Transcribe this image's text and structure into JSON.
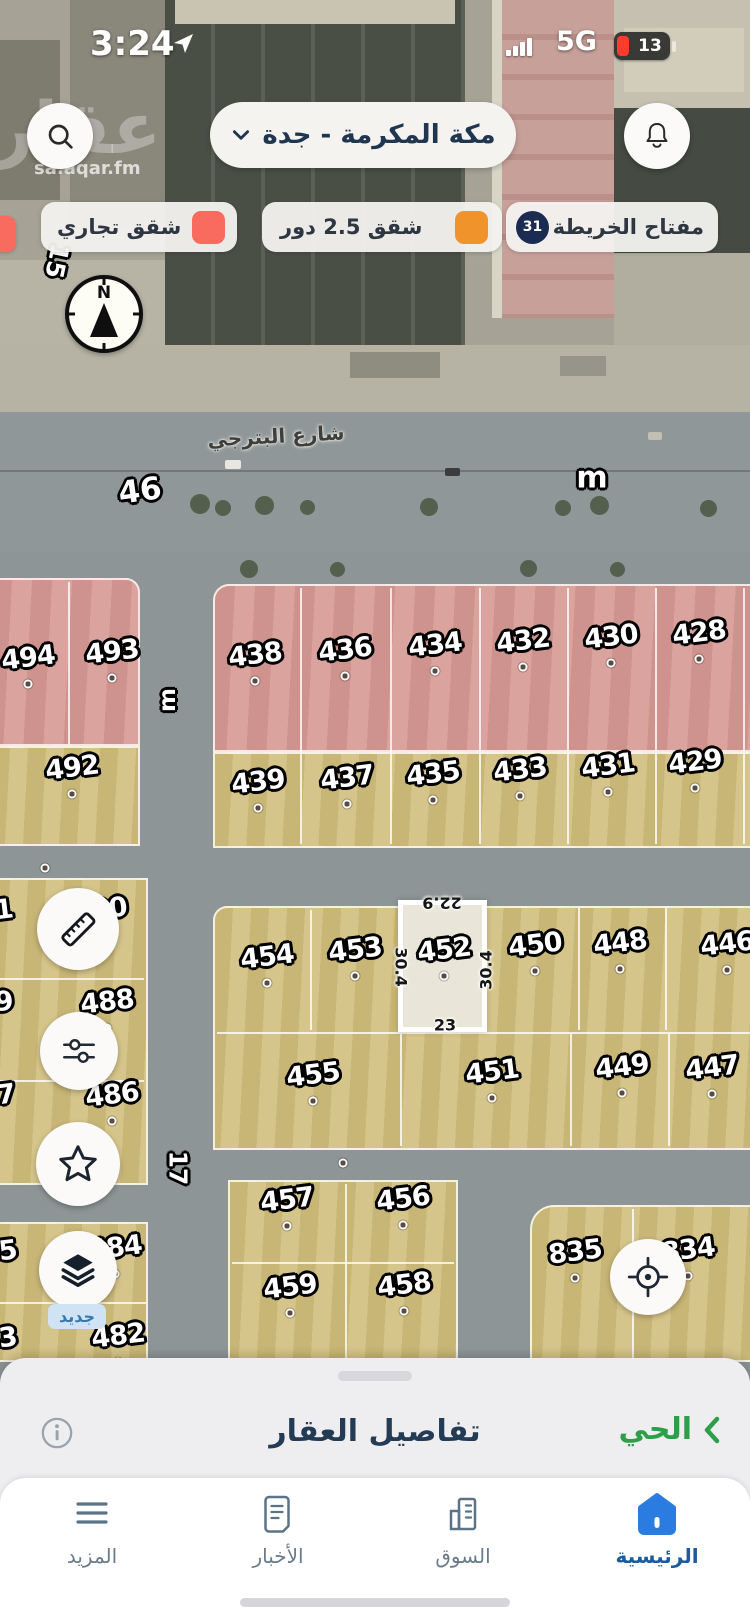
{
  "status_bar": {
    "time": "3:24",
    "network": "5G",
    "battery_percent": "13"
  },
  "watermark": {
    "logo": "عقار",
    "site": "sa.aqar.fm"
  },
  "header": {
    "location_selector": "مكة المكرمة - جدة"
  },
  "legend": {
    "map_key": {
      "label": "مفتاح الخريطة",
      "count": "31",
      "badge_color": "#1C2B52"
    },
    "chips": [
      {
        "label": "شقق 2.5 دور",
        "color": "#F1932B"
      },
      {
        "label": "شقق تجاري",
        "color": "#F96A5F"
      }
    ]
  },
  "map": {
    "street_name": "شارع البترجي",
    "compass_letter": "N",
    "new_badge": "جديد",
    "selected_parcel": "452",
    "dimensions": [
      {
        "t": "22.9",
        "x": 442,
        "y": 903,
        "rot": 180
      },
      {
        "t": "30.4",
        "x": 401,
        "y": 967,
        "rot": 90
      },
      {
        "t": "30.4",
        "x": 486,
        "y": 970,
        "rot": -90
      },
      {
        "t": "23",
        "x": 445,
        "y": 1025,
        "rot": 0
      }
    ],
    "road_labels": [
      {
        "t": "46",
        "x": 140,
        "y": 491,
        "rot": -8,
        "size": 31
      },
      {
        "t": "m",
        "x": 592,
        "y": 478,
        "rot": 0,
        "size": 30
      },
      {
        "t": "m",
        "x": 168,
        "y": 700,
        "rot": -90,
        "size": 23
      },
      {
        "t": "17",
        "x": 178,
        "y": 1168,
        "rot": 90,
        "size": 25
      },
      {
        "t": "15",
        "x": 57,
        "y": 261,
        "rot": 102,
        "size": 25
      }
    ],
    "parcels": [
      {
        "t": "494",
        "x": 28,
        "y": 658
      },
      {
        "t": "493",
        "x": 112,
        "y": 652
      },
      {
        "t": "438",
        "x": 255,
        "y": 655
      },
      {
        "t": "436",
        "x": 345,
        "y": 650
      },
      {
        "t": "434",
        "x": 435,
        "y": 645
      },
      {
        "t": "432",
        "x": 523,
        "y": 641
      },
      {
        "t": "430",
        "x": 611,
        "y": 637
      },
      {
        "t": "428",
        "x": 699,
        "y": 633
      },
      {
        "t": "492",
        "x": 72,
        "y": 768
      },
      {
        "t": "439",
        "x": 258,
        "y": 782
      },
      {
        "t": "437",
        "x": 347,
        "y": 778
      },
      {
        "t": "435",
        "x": 433,
        "y": 774
      },
      {
        "t": "433",
        "x": 520,
        "y": 770
      },
      {
        "t": "431",
        "x": 608,
        "y": 766
      },
      {
        "t": "429",
        "x": 695,
        "y": 762
      },
      {
        "t": "490",
        "x": 100,
        "y": 910
      },
      {
        "t": "488",
        "x": 107,
        "y": 1002
      },
      {
        "t": "486",
        "x": 112,
        "y": 1095
      },
      {
        "t": "484",
        "x": 115,
        "y": 1248
      },
      {
        "t": "482",
        "x": 118,
        "y": 1336
      },
      {
        "t": "454",
        "x": 267,
        "y": 957
      },
      {
        "t": "453",
        "x": 355,
        "y": 950
      },
      {
        "t": "452",
        "x": 444,
        "y": 950
      },
      {
        "t": "450",
        "x": 535,
        "y": 945
      },
      {
        "t": "448",
        "x": 620,
        "y": 943
      },
      {
        "t": "446",
        "x": 727,
        "y": 944
      },
      {
        "t": "455",
        "x": 313,
        "y": 1075
      },
      {
        "t": "451",
        "x": 492,
        "y": 1072
      },
      {
        "t": "449",
        "x": 622,
        "y": 1067
      },
      {
        "t": "447",
        "x": 712,
        "y": 1068
      },
      {
        "t": "457",
        "x": 287,
        "y": 1200
      },
      {
        "t": "456",
        "x": 403,
        "y": 1199
      },
      {
        "t": "459",
        "x": 290,
        "y": 1287
      },
      {
        "t": "458",
        "x": 404,
        "y": 1285
      },
      {
        "t": "835",
        "x": 575,
        "y": 1252
      },
      {
        "t": "834",
        "x": 688,
        "y": 1250
      },
      {
        "t": "491",
        "x": -14,
        "y": 912,
        "cut": true
      },
      {
        "t": "489",
        "x": -14,
        "y": 1004,
        "cut": true
      },
      {
        "t": "487",
        "x": -12,
        "y": 1097,
        "cut": true
      },
      {
        "t": "485",
        "x": -10,
        "y": 1253,
        "cut": true
      },
      {
        "t": "483",
        "x": -10,
        "y": 1340,
        "cut": true
      }
    ],
    "extra_dots": [
      [
        45,
        868
      ],
      [
        343,
        1163
      ]
    ]
  },
  "bottom_sheet": {
    "title": "تفاصيل العقار",
    "neighborhood_link": "الحي"
  },
  "nav": {
    "items": [
      {
        "label": "الرئيسية",
        "active": true
      },
      {
        "label": "السوق",
        "active": false
      },
      {
        "label": "الأخبار",
        "active": false
      },
      {
        "label": "المزيد",
        "active": false
      }
    ]
  }
}
